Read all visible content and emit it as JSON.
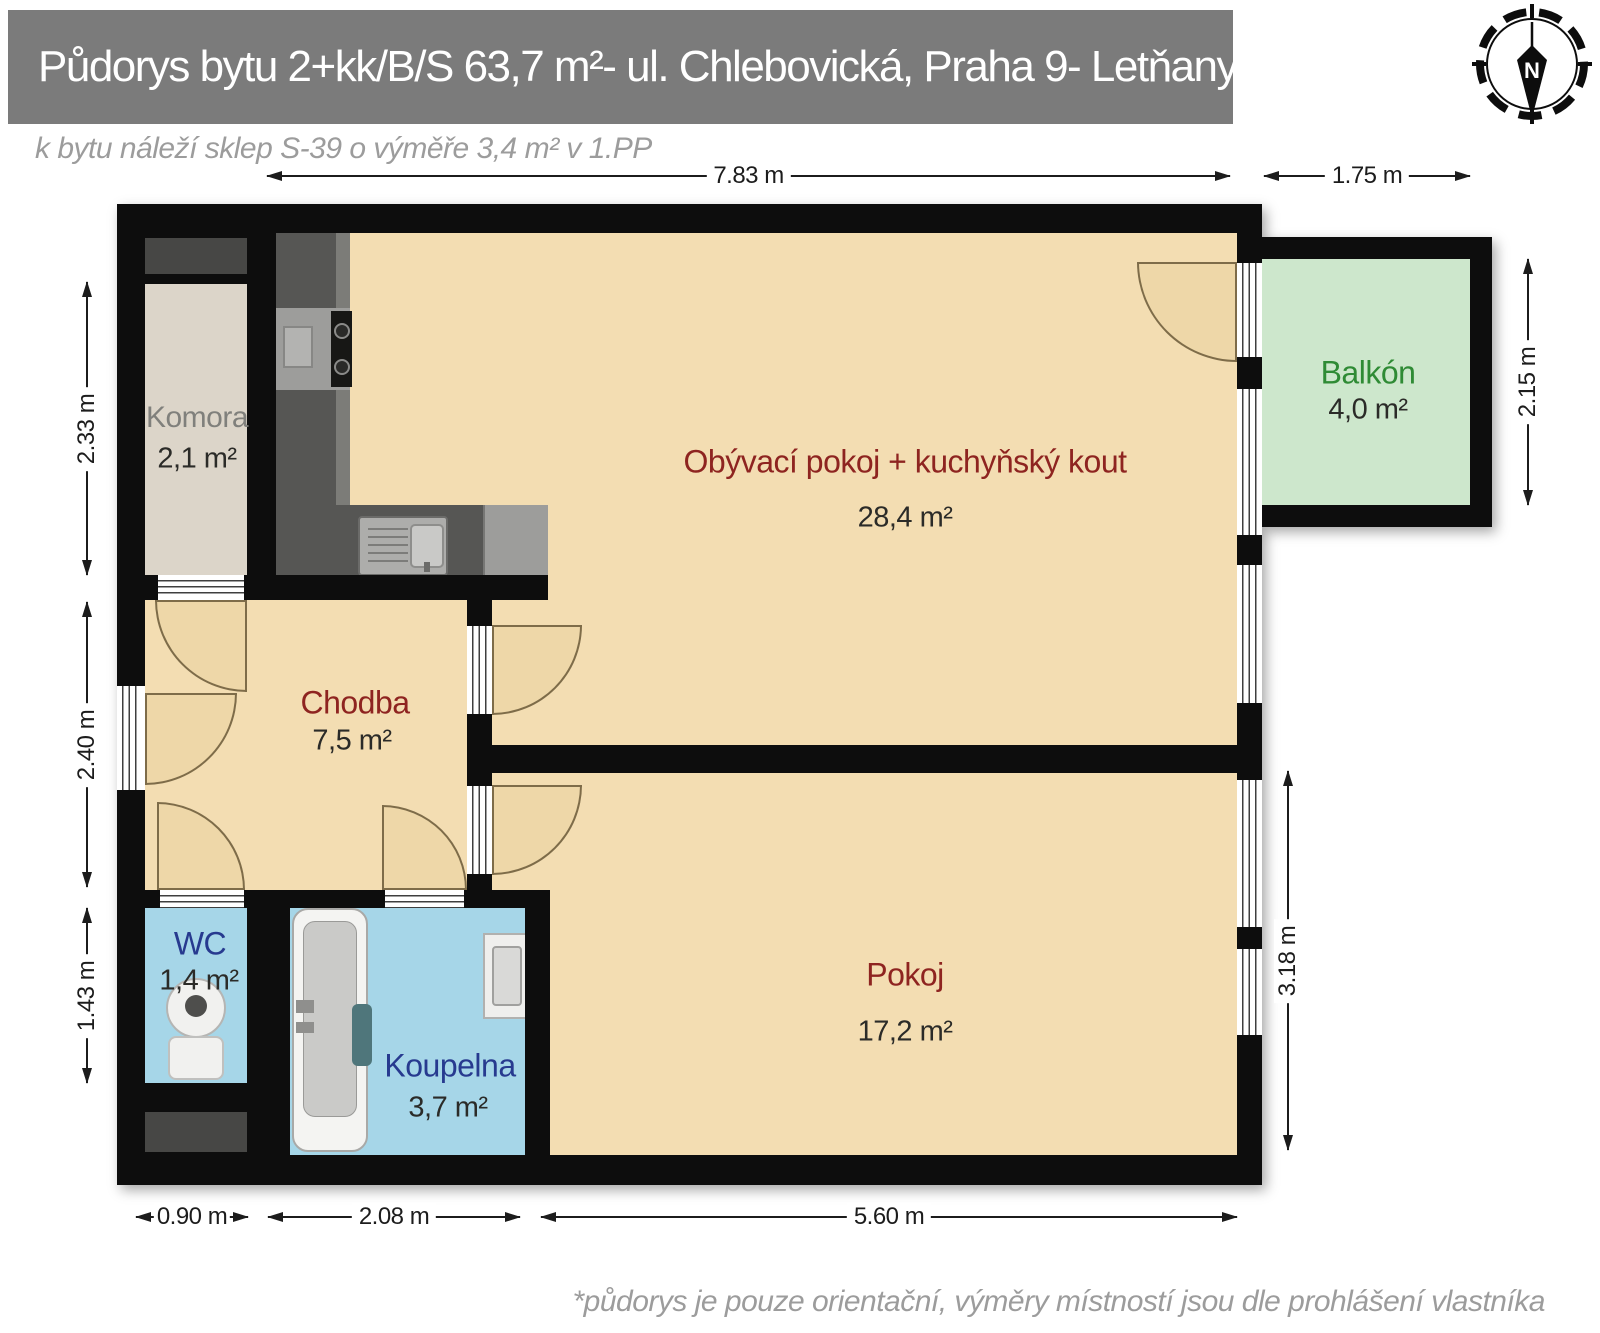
{
  "header": {
    "title": "Půdorys bytu 2+kk/B/S 63,7 m²- ul. Chlebovická, Praha 9- Letňany"
  },
  "notes": {
    "subtitle": "k bytu náleží sklep S-39 o výměře 3,4 m² v 1.PP",
    "footer": "*půdorys je pouze orientační, výměry místností jsou dle prohlášení vlastníka"
  },
  "compass": {
    "label": "N"
  },
  "rooms": {
    "komora": {
      "name": "Komora",
      "area": "2,1 m²"
    },
    "living": {
      "name": "Obývací pokoj + kuchyňský kout",
      "area": "28,4 m²"
    },
    "balkon": {
      "name": "Balkón",
      "area": "4,0 m²"
    },
    "chodba": {
      "name": "Chodba",
      "area": "7,5 m²"
    },
    "wc": {
      "name": "WC",
      "area": "1,4 m²"
    },
    "koupelna": {
      "name": "Koupelna",
      "area": "3,7 m²"
    },
    "pokoj": {
      "name": "Pokoj",
      "area": "17,2 m²"
    }
  },
  "dimensions": {
    "top_main": "7.83 m",
    "top_balcony": "1.75 m",
    "left_komora": "2.33 m",
    "left_chodba": "2.40 m",
    "left_wc": "1.43 m",
    "right_balcony": "2.15 m",
    "right_pokoj": "3.18 m",
    "bottom_wc": "0.90 m",
    "bottom_koupelna": "2.08 m",
    "bottom_pokoj": "5.60 m"
  },
  "colors": {
    "header-bg": "#7b7b7b",
    "header-text": "#ffffff",
    "muted-text": "#9c9c9c",
    "wall": "#0d0d0d",
    "floor": "#f3ddb2",
    "komora-floor": "#dcd5c9",
    "wet": "#a6d6e8",
    "balcony": "#cde7cc",
    "arc": "#eed7a8",
    "arc-line": "#7e6c49",
    "name-red": "#8e2420",
    "name-blue": "#273a8f",
    "name-green": "#2f8b35",
    "name-gray": "#80807c",
    "area-text": "#2b2b28",
    "dim-text": "#1c1c1c",
    "counter": "#565654",
    "counter-light": "#7c7c78",
    "appliance": "#9d9d9b",
    "shaft": "#474745"
  }
}
